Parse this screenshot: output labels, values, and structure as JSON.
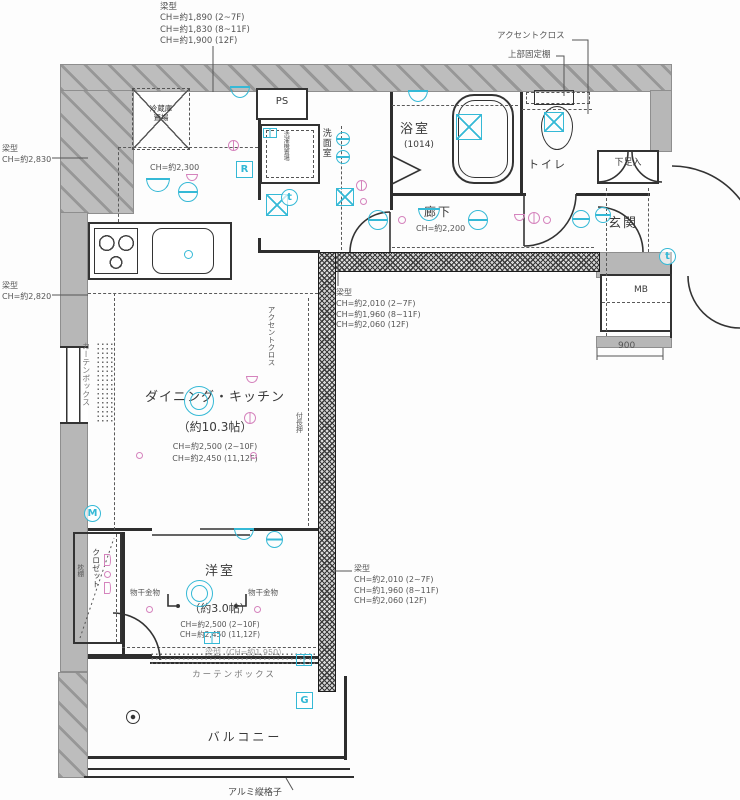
{
  "annotations": {
    "beam_top": {
      "title": "梁型",
      "l1": "CH=約1,890 (2~7F)",
      "l2": "CH=約1,830 (8~11F)",
      "l3": "CH=約1,900 (12F)"
    },
    "accent_top": "アクセントクロス",
    "upper_shelf": "上部固定棚",
    "beam_left_upper": {
      "title": "梁型",
      "l1": "CH=約2,830"
    },
    "beam_left_lower": {
      "title": "梁型",
      "l1": "CH=約2,820"
    },
    "beam_mid": {
      "title": "梁型",
      "l1": "CH=約2,010 (2~7F)",
      "l2": "CH=約1,960 (8~11F)",
      "l3": "CH=約2,060 (12F)"
    },
    "beam_right": {
      "title": "梁型",
      "l1": "CH=約2,010 (2~7F)",
      "l2": "CH=約1,960 (8~11F)",
      "l3": "CH=約2,060 (12F)"
    },
    "beam_bottom": "梁型（CH=約1,950）",
    "lattice": "アルミ縦格子",
    "dim_900": "900"
  },
  "rooms": {
    "refrigerator_l1": "冷蔵庫",
    "refrigerator_l2": "置場",
    "ps": "PS",
    "washroom": "洗面室",
    "washer": "洗濯機置場",
    "kitchen_ch": "CH=約2,300",
    "bath": "浴室",
    "bath_size": "(1014)",
    "toilet": "トイレ",
    "corridor": "廊下",
    "corridor_ch": "CH=約2,200",
    "shoe": "下足入",
    "entrance": "玄関",
    "mb": "MB",
    "dining": "ダイニング・キッチン",
    "dining_size": "（約10.3帖）",
    "dining_ch1": "CH=約2,500 (2~10F)",
    "dining_ch2": "CH=約2,450 (11,12F)",
    "accent_side": "アクセントクロス",
    "nageshi": "付長押",
    "closet": "クロゼット",
    "shelf": "枕棚",
    "western": "洋室",
    "western_size": "（約3.0帖）",
    "western_ch1": "CH=約2,500 (2~10F)",
    "western_ch2": "CH=約2,450 (11,12F)",
    "hook_l": "物干金物",
    "hook_r": "物干金物",
    "curtain_left": "カーテンボックス",
    "curtain_bottom": "カーテンボックス",
    "balcony": "バルコニー"
  },
  "colors": {
    "accent_cyan": "#35b9d6",
    "accent_pink": "#d583bd",
    "wall_gray": "#b7b7b7"
  },
  "badges": [
    {
      "label": "R",
      "shape": "sq",
      "x": 236,
      "y": 161
    },
    {
      "label": "t",
      "shape": "ci",
      "x": 281,
      "y": 189
    },
    {
      "label": "t",
      "shape": "ci",
      "x": 659,
      "y": 248
    },
    {
      "label": "M",
      "shape": "ci",
      "x": 84,
      "y": 505
    },
    {
      "label": "G",
      "shape": "sq",
      "x": 296,
      "y": 692
    }
  ],
  "symbols": [
    {
      "name": "ceiling-light-icon",
      "type": "semi",
      "x": 146,
      "y": 178,
      "s": 24
    },
    {
      "name": "ceiling-light-icon",
      "type": "circ",
      "x": 178,
      "y": 182,
      "s": 20
    },
    {
      "name": "ceiling-light-icon",
      "type": "semi",
      "x": 230,
      "y": 86,
      "s": 20
    },
    {
      "name": "switch-icon",
      "type": "psemi",
      "x": 186,
      "y": 174,
      "s": 12
    },
    {
      "name": "switch-icon",
      "type": "pring",
      "x": 228,
      "y": 140,
      "s": 11
    },
    {
      "name": "downlight-icon",
      "type": "circ",
      "x": 336,
      "y": 132,
      "s": 14
    },
    {
      "name": "downlight-icon",
      "type": "circ",
      "x": 336,
      "y": 150,
      "s": 14
    },
    {
      "name": "vent-fan-icon",
      "type": "xsq",
      "x": 266,
      "y": 194,
      "s": 22
    },
    {
      "name": "vent-fan-icon",
      "type": "xsq",
      "x": 336,
      "y": 188,
      "s": 18
    },
    {
      "name": "switch-icon",
      "type": "pring",
      "x": 356,
      "y": 180,
      "s": 11
    },
    {
      "name": "outlet-icon",
      "type": "pdot",
      "x": 360,
      "y": 198,
      "s": 7
    },
    {
      "name": "ceiling-light-icon",
      "type": "semi",
      "x": 408,
      "y": 90,
      "s": 20
    },
    {
      "name": "vent-fan-icon",
      "type": "xsq",
      "x": 456,
      "y": 114,
      "s": 26
    },
    {
      "name": "vent-fan-icon",
      "type": "xsq",
      "x": 544,
      "y": 112,
      "s": 20
    },
    {
      "name": "ceiling-light-icon",
      "type": "circ",
      "x": 368,
      "y": 210,
      "s": 20
    },
    {
      "name": "outlet-icon",
      "type": "pdot",
      "x": 398,
      "y": 216,
      "s": 8
    },
    {
      "name": "ceiling-light-icon",
      "type": "semi",
      "x": 418,
      "y": 208,
      "s": 22
    },
    {
      "name": "ceiling-light-icon",
      "type": "circ",
      "x": 468,
      "y": 210,
      "s": 20
    },
    {
      "name": "switch-icon",
      "type": "psemi",
      "x": 514,
      "y": 214,
      "s": 11
    },
    {
      "name": "switch-icon",
      "type": "pring",
      "x": 528,
      "y": 212,
      "s": 12
    },
    {
      "name": "outlet-icon",
      "type": "pdot",
      "x": 543,
      "y": 216,
      "s": 8
    },
    {
      "name": "ceiling-light-icon",
      "type": "circ",
      "x": 572,
      "y": 210,
      "s": 18
    },
    {
      "name": "ceiling-light-icon",
      "type": "circ",
      "x": 595,
      "y": 207,
      "s": 16
    },
    {
      "name": "main-light-icon",
      "type": "dbl",
      "x": 184,
      "y": 386,
      "s": 30
    },
    {
      "name": "switch-icon",
      "type": "psemi",
      "x": 246,
      "y": 376,
      "s": 12
    },
    {
      "name": "switch-icon",
      "type": "pring",
      "x": 244,
      "y": 412,
      "s": 12
    },
    {
      "name": "outlet-icon",
      "type": "pdot",
      "x": 136,
      "y": 452,
      "s": 7
    },
    {
      "name": "outlet-icon",
      "type": "pdot",
      "x": 250,
      "y": 452,
      "s": 7
    },
    {
      "name": "ceiling-light-icon",
      "type": "semi",
      "x": 234,
      "y": 528,
      "s": 20
    },
    {
      "name": "ceiling-light-icon",
      "type": "circ",
      "x": 266,
      "y": 531,
      "s": 17
    },
    {
      "name": "faucet-icon",
      "type": "cdot",
      "x": 184,
      "y": 250,
      "s": 9
    },
    {
      "name": "main-light-icon",
      "type": "dbl",
      "x": 186,
      "y": 580,
      "s": 27
    },
    {
      "name": "outlet-icon",
      "type": "pdot",
      "x": 146,
      "y": 606,
      "s": 7
    },
    {
      "name": "outlet-icon",
      "type": "pdot",
      "x": 254,
      "y": 606,
      "s": 7
    },
    {
      "name": "switch-icon",
      "type": "pdhalf",
      "x": 104,
      "y": 554,
      "s": 12
    },
    {
      "name": "outlet-icon",
      "type": "pdot",
      "x": 104,
      "y": 571,
      "s": 7
    },
    {
      "name": "switch-icon",
      "type": "pdhalf",
      "x": 104,
      "y": 582,
      "s": 12
    },
    {
      "name": "window-lock-icon",
      "type": "crect",
      "x": 204,
      "y": 632,
      "s": 16
    },
    {
      "name": "window-lock-icon",
      "type": "crect",
      "x": 296,
      "y": 654,
      "s": 16
    },
    {
      "name": "washer-faucet-icon",
      "type": "crect",
      "x": 263,
      "y": 128,
      "s": 14
    },
    {
      "name": "drain-cap-icon",
      "type": "blk",
      "x": 126,
      "y": 710,
      "s": 14
    }
  ]
}
